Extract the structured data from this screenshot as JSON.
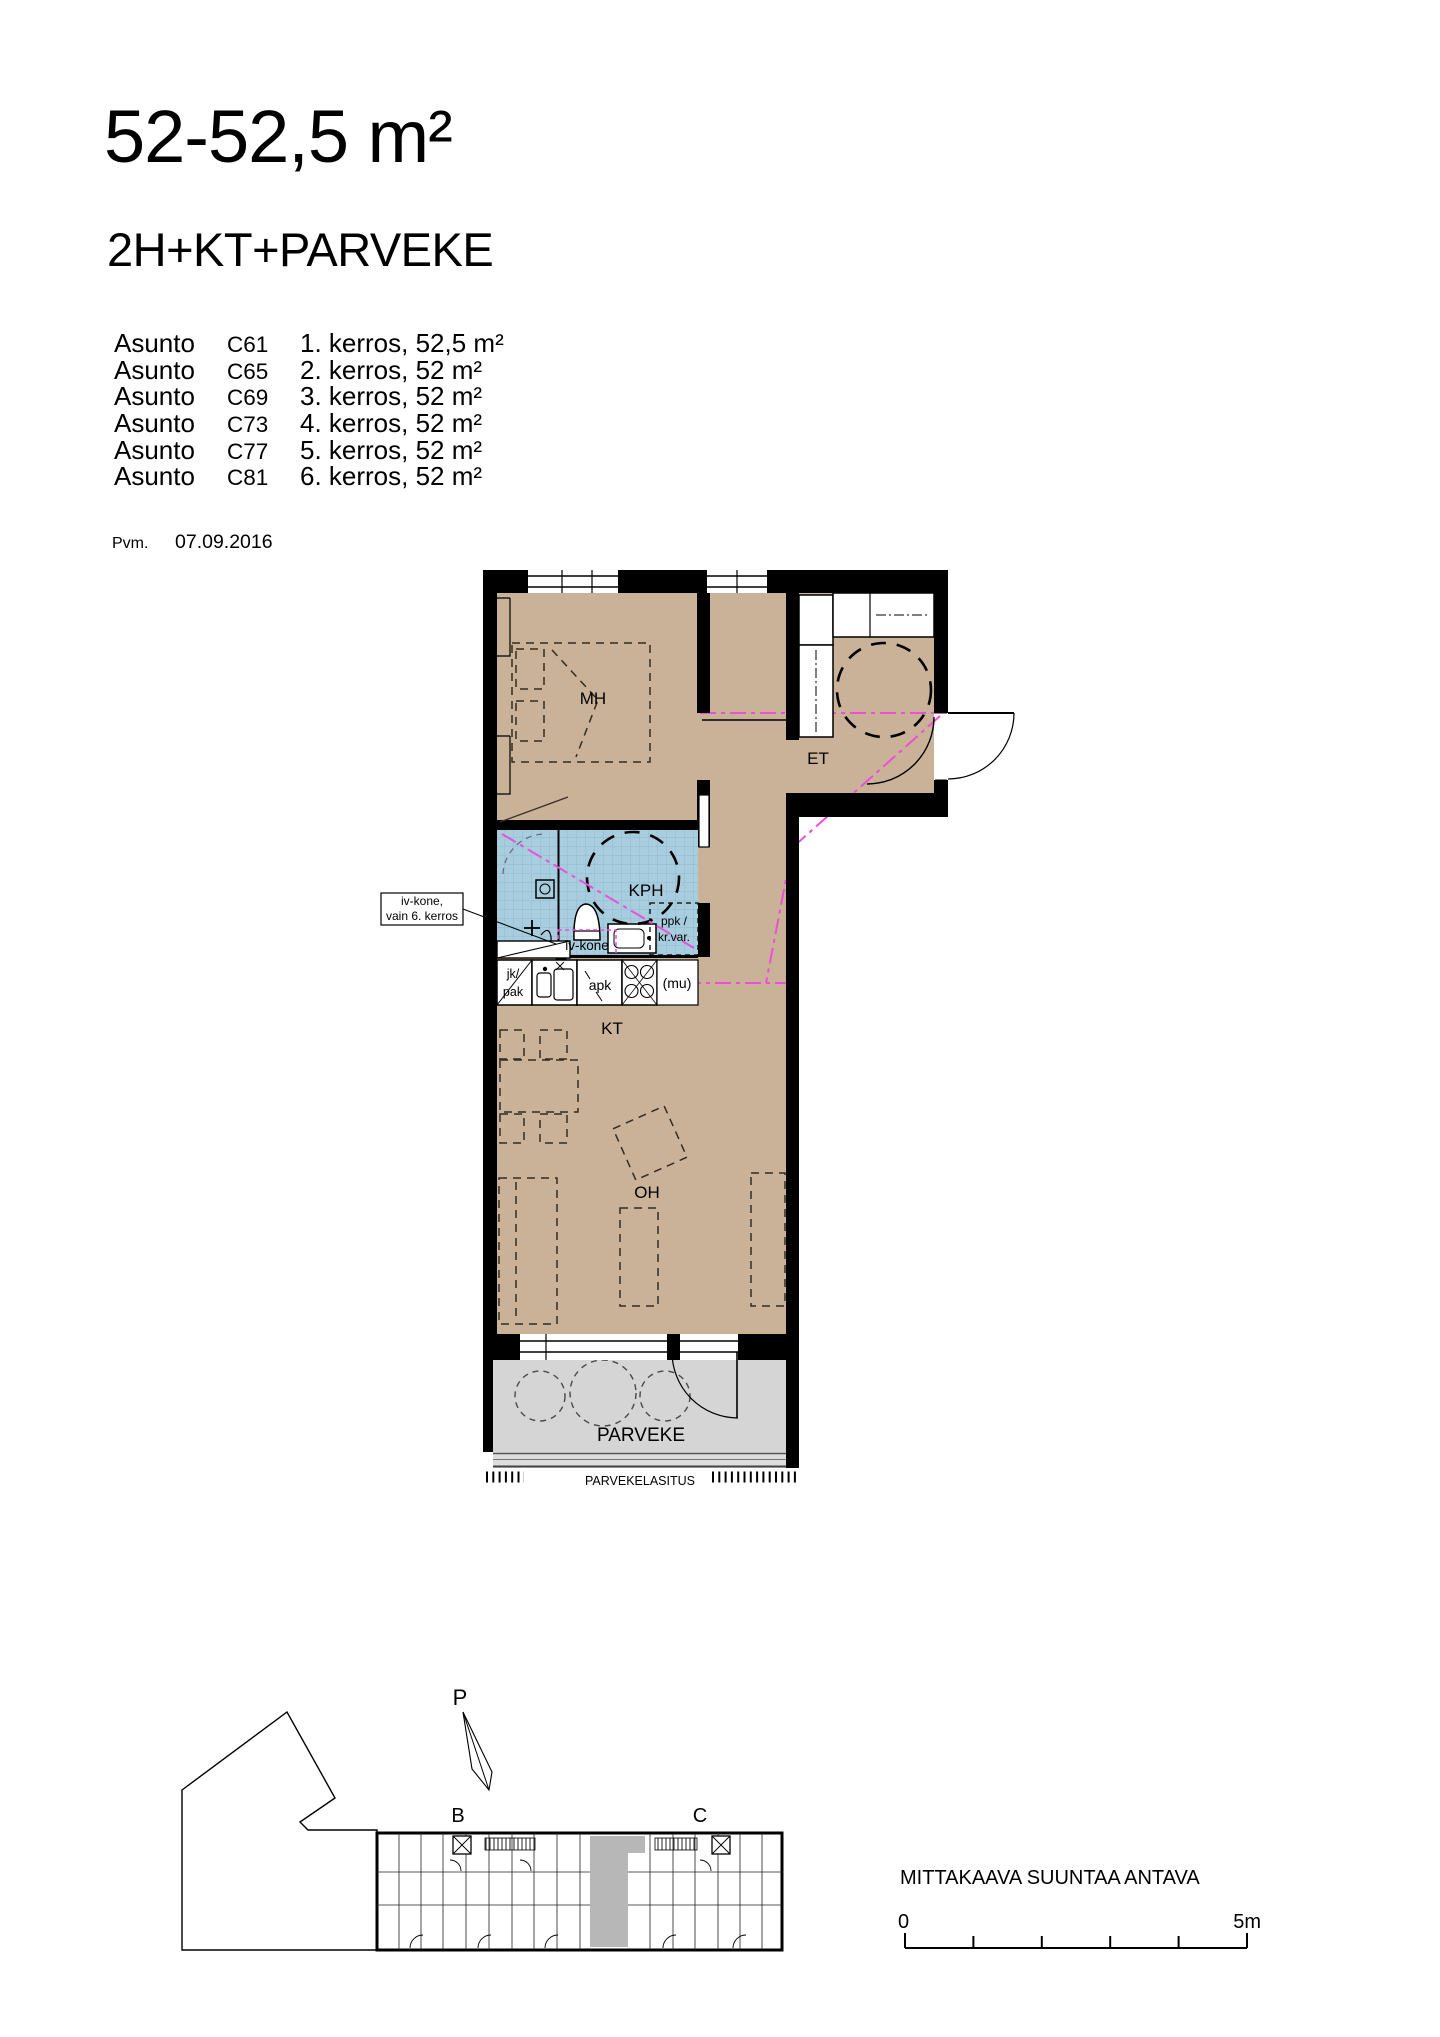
{
  "header": {
    "title": "52-52,5 m²",
    "subtitle": "2H+KT+PARVEKE",
    "apartments": [
      {
        "name": "Asunto",
        "unit": "C61",
        "info": "1. kerros, 52,5 m²"
      },
      {
        "name": "Asunto",
        "unit": "C65",
        "info": "2. kerros, 52 m²"
      },
      {
        "name": "Asunto",
        "unit": "C69",
        "info": "3. kerros, 52 m²"
      },
      {
        "name": "Asunto",
        "unit": "C73",
        "info": "4. kerros, 52 m²"
      },
      {
        "name": "Asunto",
        "unit": "C77",
        "info": "5. kerros, 52 m²"
      },
      {
        "name": "Asunto",
        "unit": "C81",
        "info": "6. kerros, 52 m²"
      }
    ],
    "date_label": "Pvm.",
    "date_value": "07.09.2016"
  },
  "floorplan": {
    "rooms": {
      "mh": "MH",
      "et": "ET",
      "kph": "KPH",
      "kt": "KT",
      "oh": "OH",
      "parveke": "PARVEKE"
    },
    "annotations": {
      "callout_line1": "iv-kone,",
      "callout_line2": "vain 6. kerros",
      "iv_kone": "iv-kone",
      "jk_line1": "jk/",
      "jk_line2": "pak",
      "apk": "apk",
      "mu": "(mu)",
      "ppk_line1": "ppk /",
      "ppk_line2": "kr.var.",
      "glazing": "PARVEKELASITUS"
    },
    "colors": {
      "floor": "#c9b298",
      "wet_room": "#a8cdde",
      "balcony": "#d5d5d5",
      "wall": "#000000",
      "access_path": "#ed4fd6"
    }
  },
  "siteplan": {
    "north": "P",
    "stair_b": "B",
    "stair_c": "C",
    "scale_note": "MITTAKAAVA SUUNTAA ANTAVA",
    "scale_zero": "0",
    "scale_five": "5m"
  }
}
